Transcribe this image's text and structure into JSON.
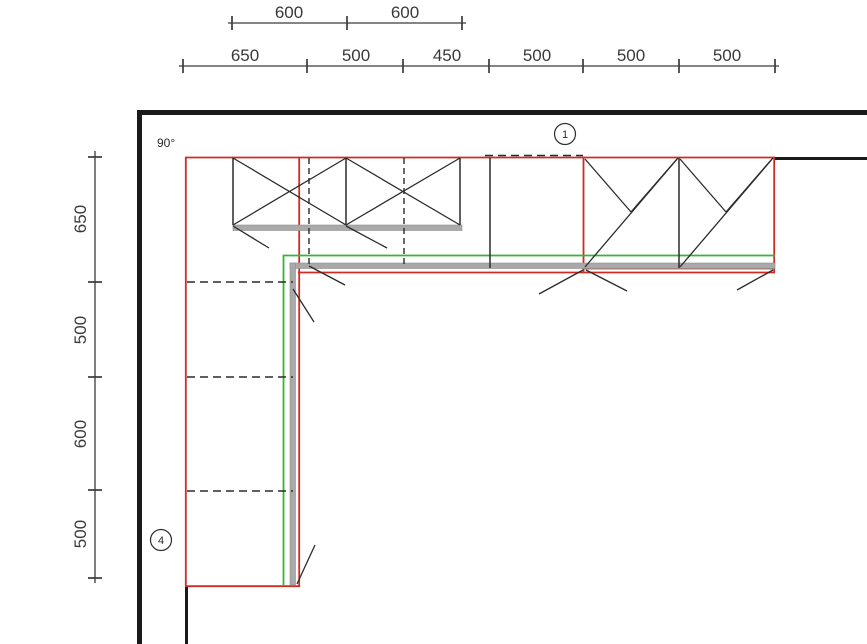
{
  "colors": {
    "bg": "#ffffff",
    "wall": "#1a1a1a",
    "line": "#2b2b2b",
    "dimline": "#3a3a3a",
    "text": "#3a3a3a",
    "red": "#cf2b24",
    "green": "#35b435",
    "grey": "#a9a9a9"
  },
  "dims": {
    "top_upper": [
      "600",
      "600"
    ],
    "top_lower": [
      "650",
      "500",
      "450",
      "500",
      "500",
      "500"
    ],
    "left": [
      "650",
      "500",
      "600",
      "500"
    ]
  },
  "annotations": {
    "angle": "90°",
    "markers": [
      {
        "label": "1"
      },
      {
        "label": "4"
      }
    ]
  }
}
